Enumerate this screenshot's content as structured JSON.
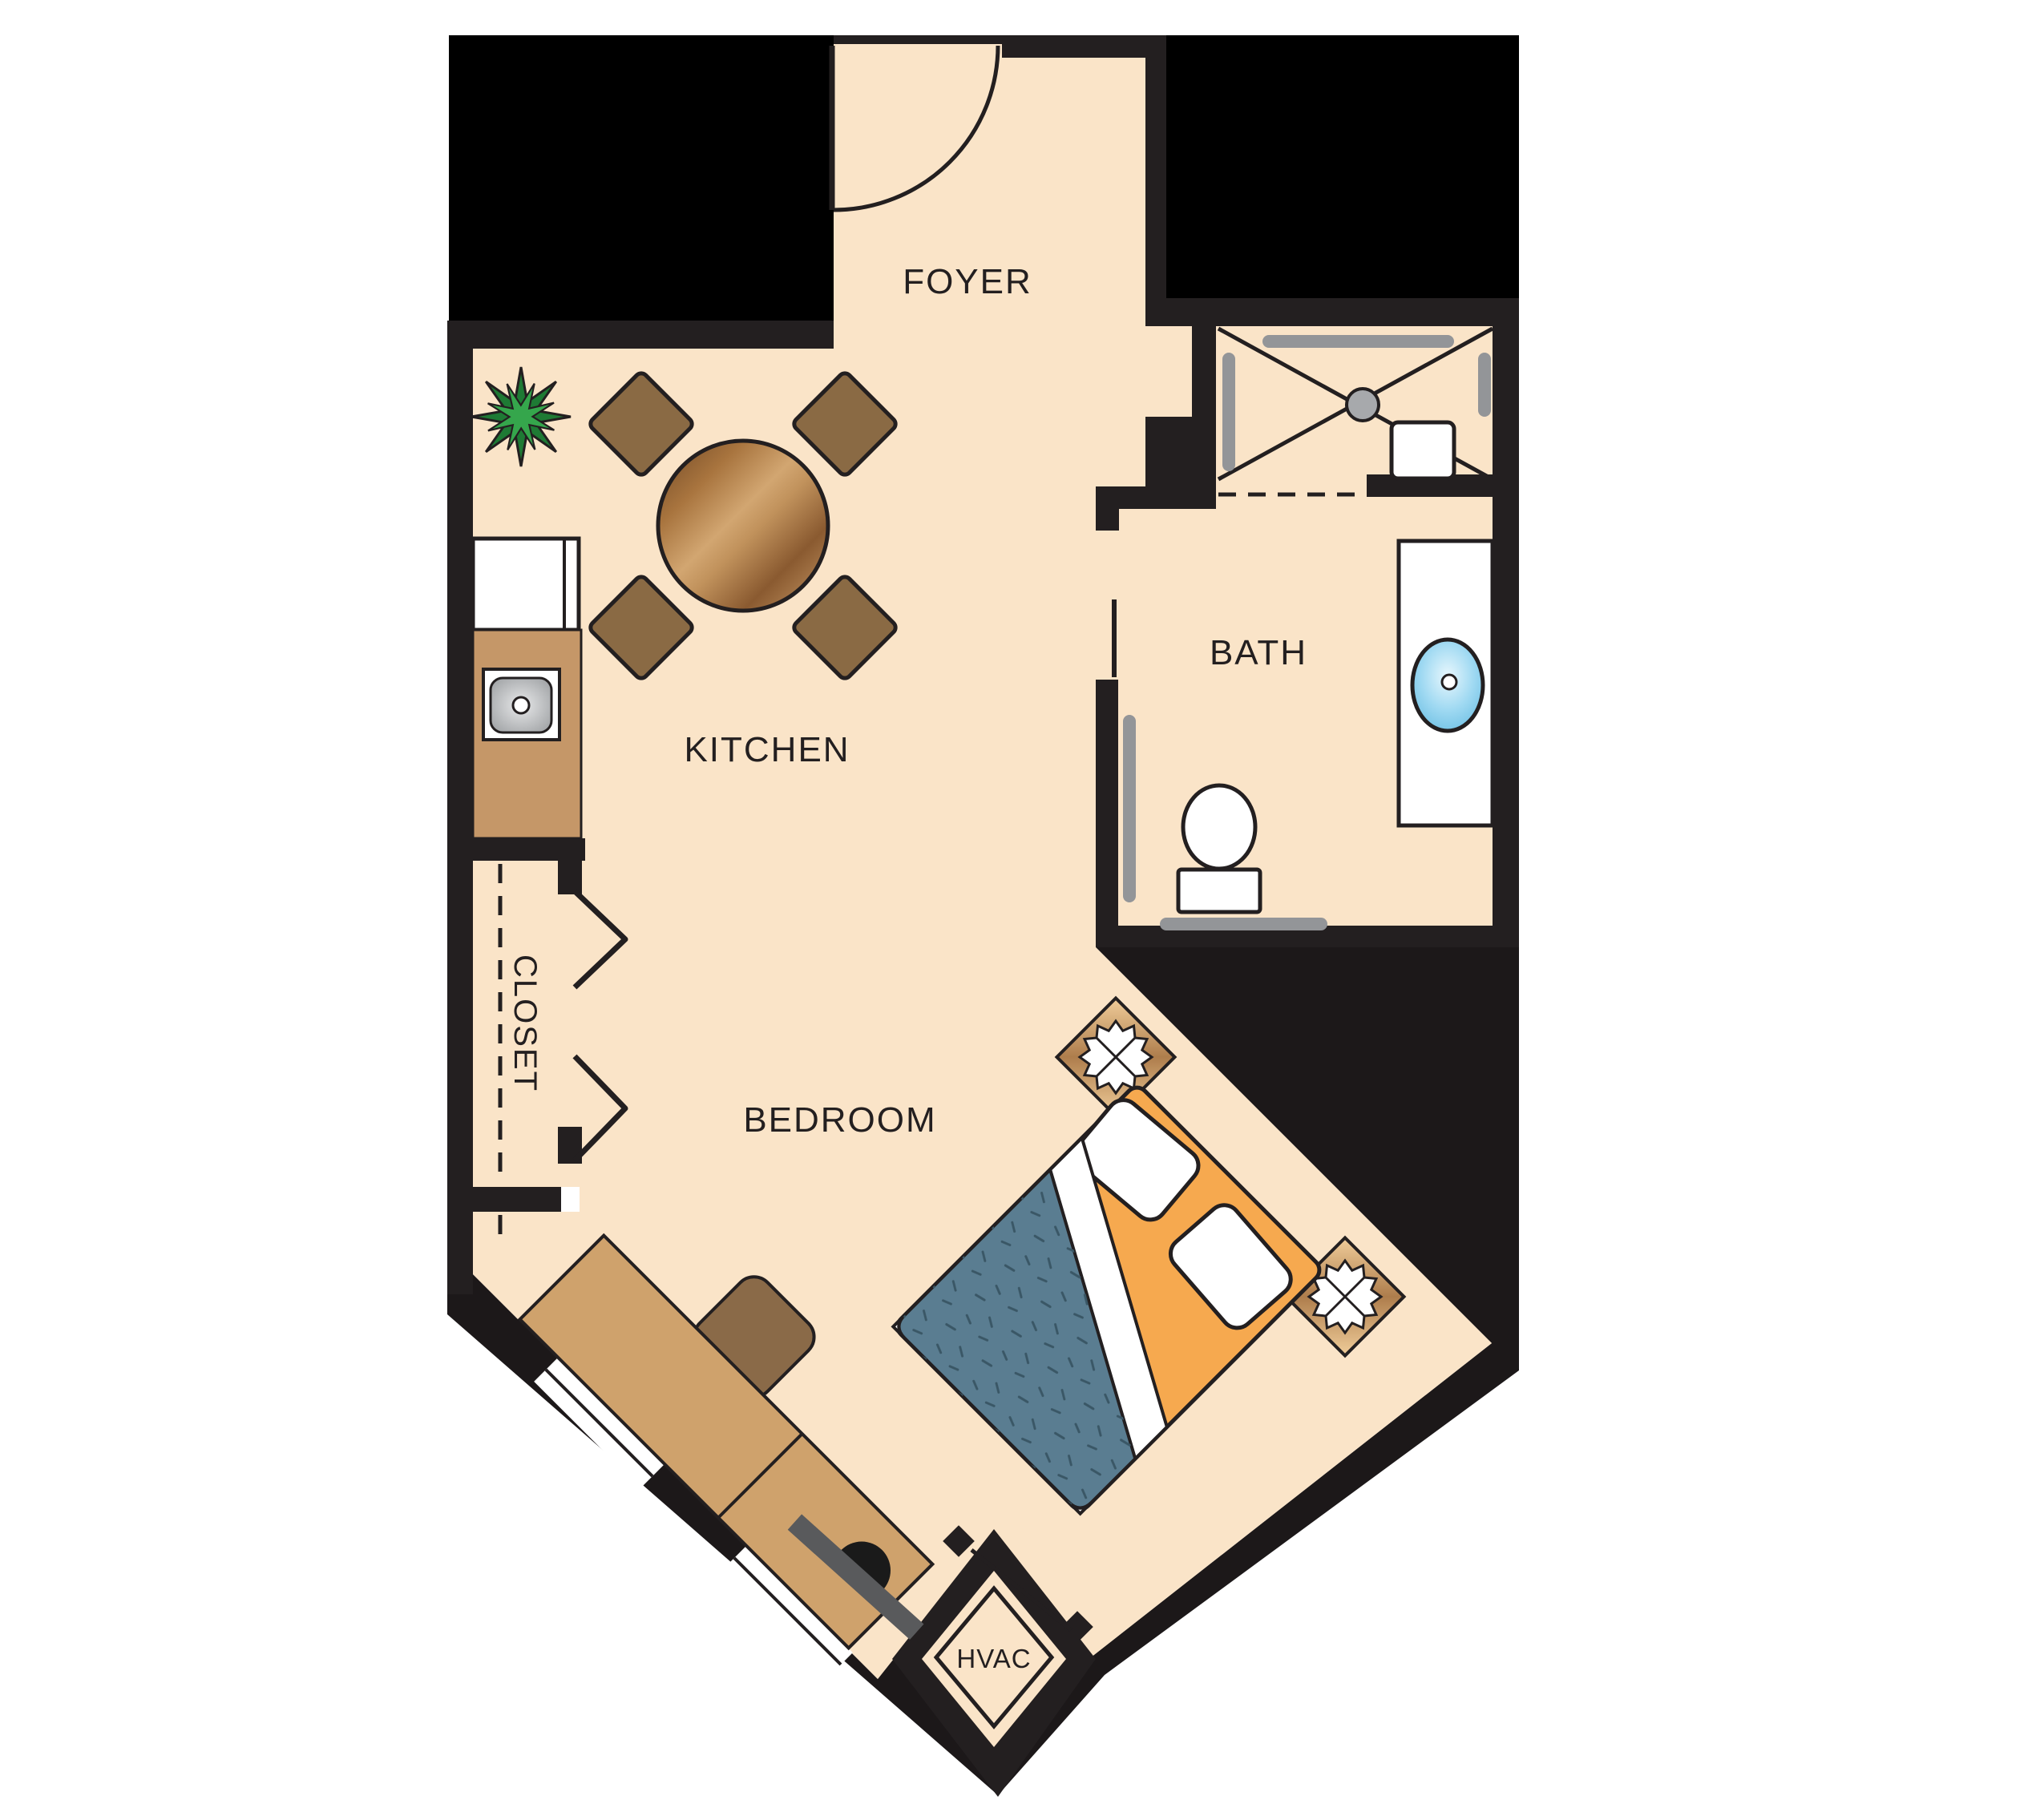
{
  "title": "Studio apartment floor plan",
  "labels": {
    "foyer": "FOYER",
    "kitchen": "KITCHEN",
    "closet": "CLOSET",
    "bedroom": "BEDROOM",
    "bath": "BATH",
    "hvac": "HVAC"
  },
  "colors": {
    "canvas": "#FFFFFF",
    "floor": "#FAE4C8",
    "wall": "#231F20",
    "void": "#000000",
    "counter_tan": "#C59768",
    "desk_tan": "#CFA26C",
    "chair_brown": "#8A6A48",
    "bed_frame_orange": "#F6A94F",
    "blanket_blue": "#5A7D91",
    "blanket_speckle": "#3A5766",
    "sink_blue": "#9FD9F2",
    "grab_bar_gray": "#939598",
    "drain_gray": "#A7A9AC",
    "plant_green_dark": "#1E7A34",
    "plant_green_light": "#35A64C",
    "tv_gray": "#595A5C",
    "fixture_white": "#FFFFFF"
  },
  "icons": [
    "entry-door-swing-icon",
    "dining-table-icon",
    "dining-chair-icon",
    "potted-plant-icon",
    "refrigerator-icon",
    "kitchen-sink-icon",
    "shower-icon",
    "shower-drain-icon",
    "grab-bar-icon",
    "shower-seat-icon",
    "vanity-sink-icon",
    "toilet-icon",
    "bifold-door-icon",
    "bed-icon",
    "pillow-icon",
    "nightstand-icon",
    "lamp-icon",
    "window-icon",
    "desk-icon",
    "desk-chair-icon",
    "tv-icon",
    "hvac-door-icon"
  ]
}
